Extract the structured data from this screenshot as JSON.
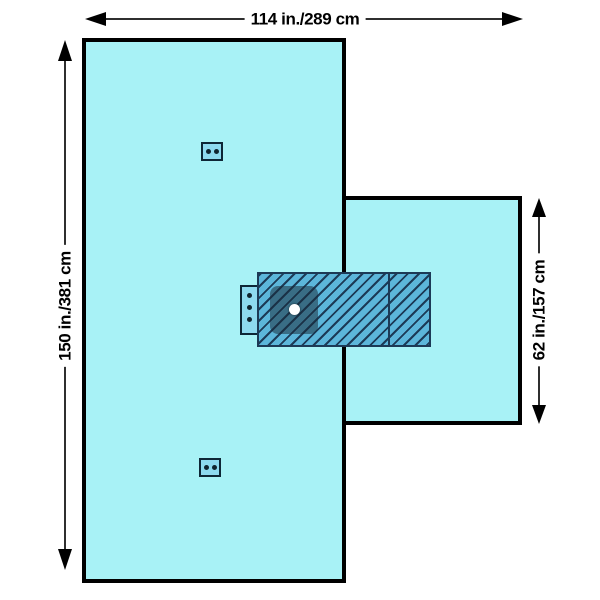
{
  "colors": {
    "canvas_bg": "#ffffff",
    "drape_fill": "#a8f2f6",
    "drape_outline": "#000000",
    "hatch_fill": "#5cb6da",
    "hatch_line": "#1c3a56",
    "patch_fill": "rgba(25,42,56,0.52)",
    "tab_fill": "#8edaef",
    "eyelet_color": "#10242f",
    "dim_line": "#2f2f2f",
    "dim_text": "#000000"
  },
  "dimensions": {
    "width_label": "114 in./289 cm",
    "height_label": "150 in./381 cm",
    "extension_label": "62 in./157 cm"
  },
  "markers": {
    "tube_organizer_tab_eyelets": 3,
    "securement_tab_top_eyelets": 2,
    "securement_tab_bottom_eyelets": 2,
    "fenestration_marker": "white-dot"
  }
}
